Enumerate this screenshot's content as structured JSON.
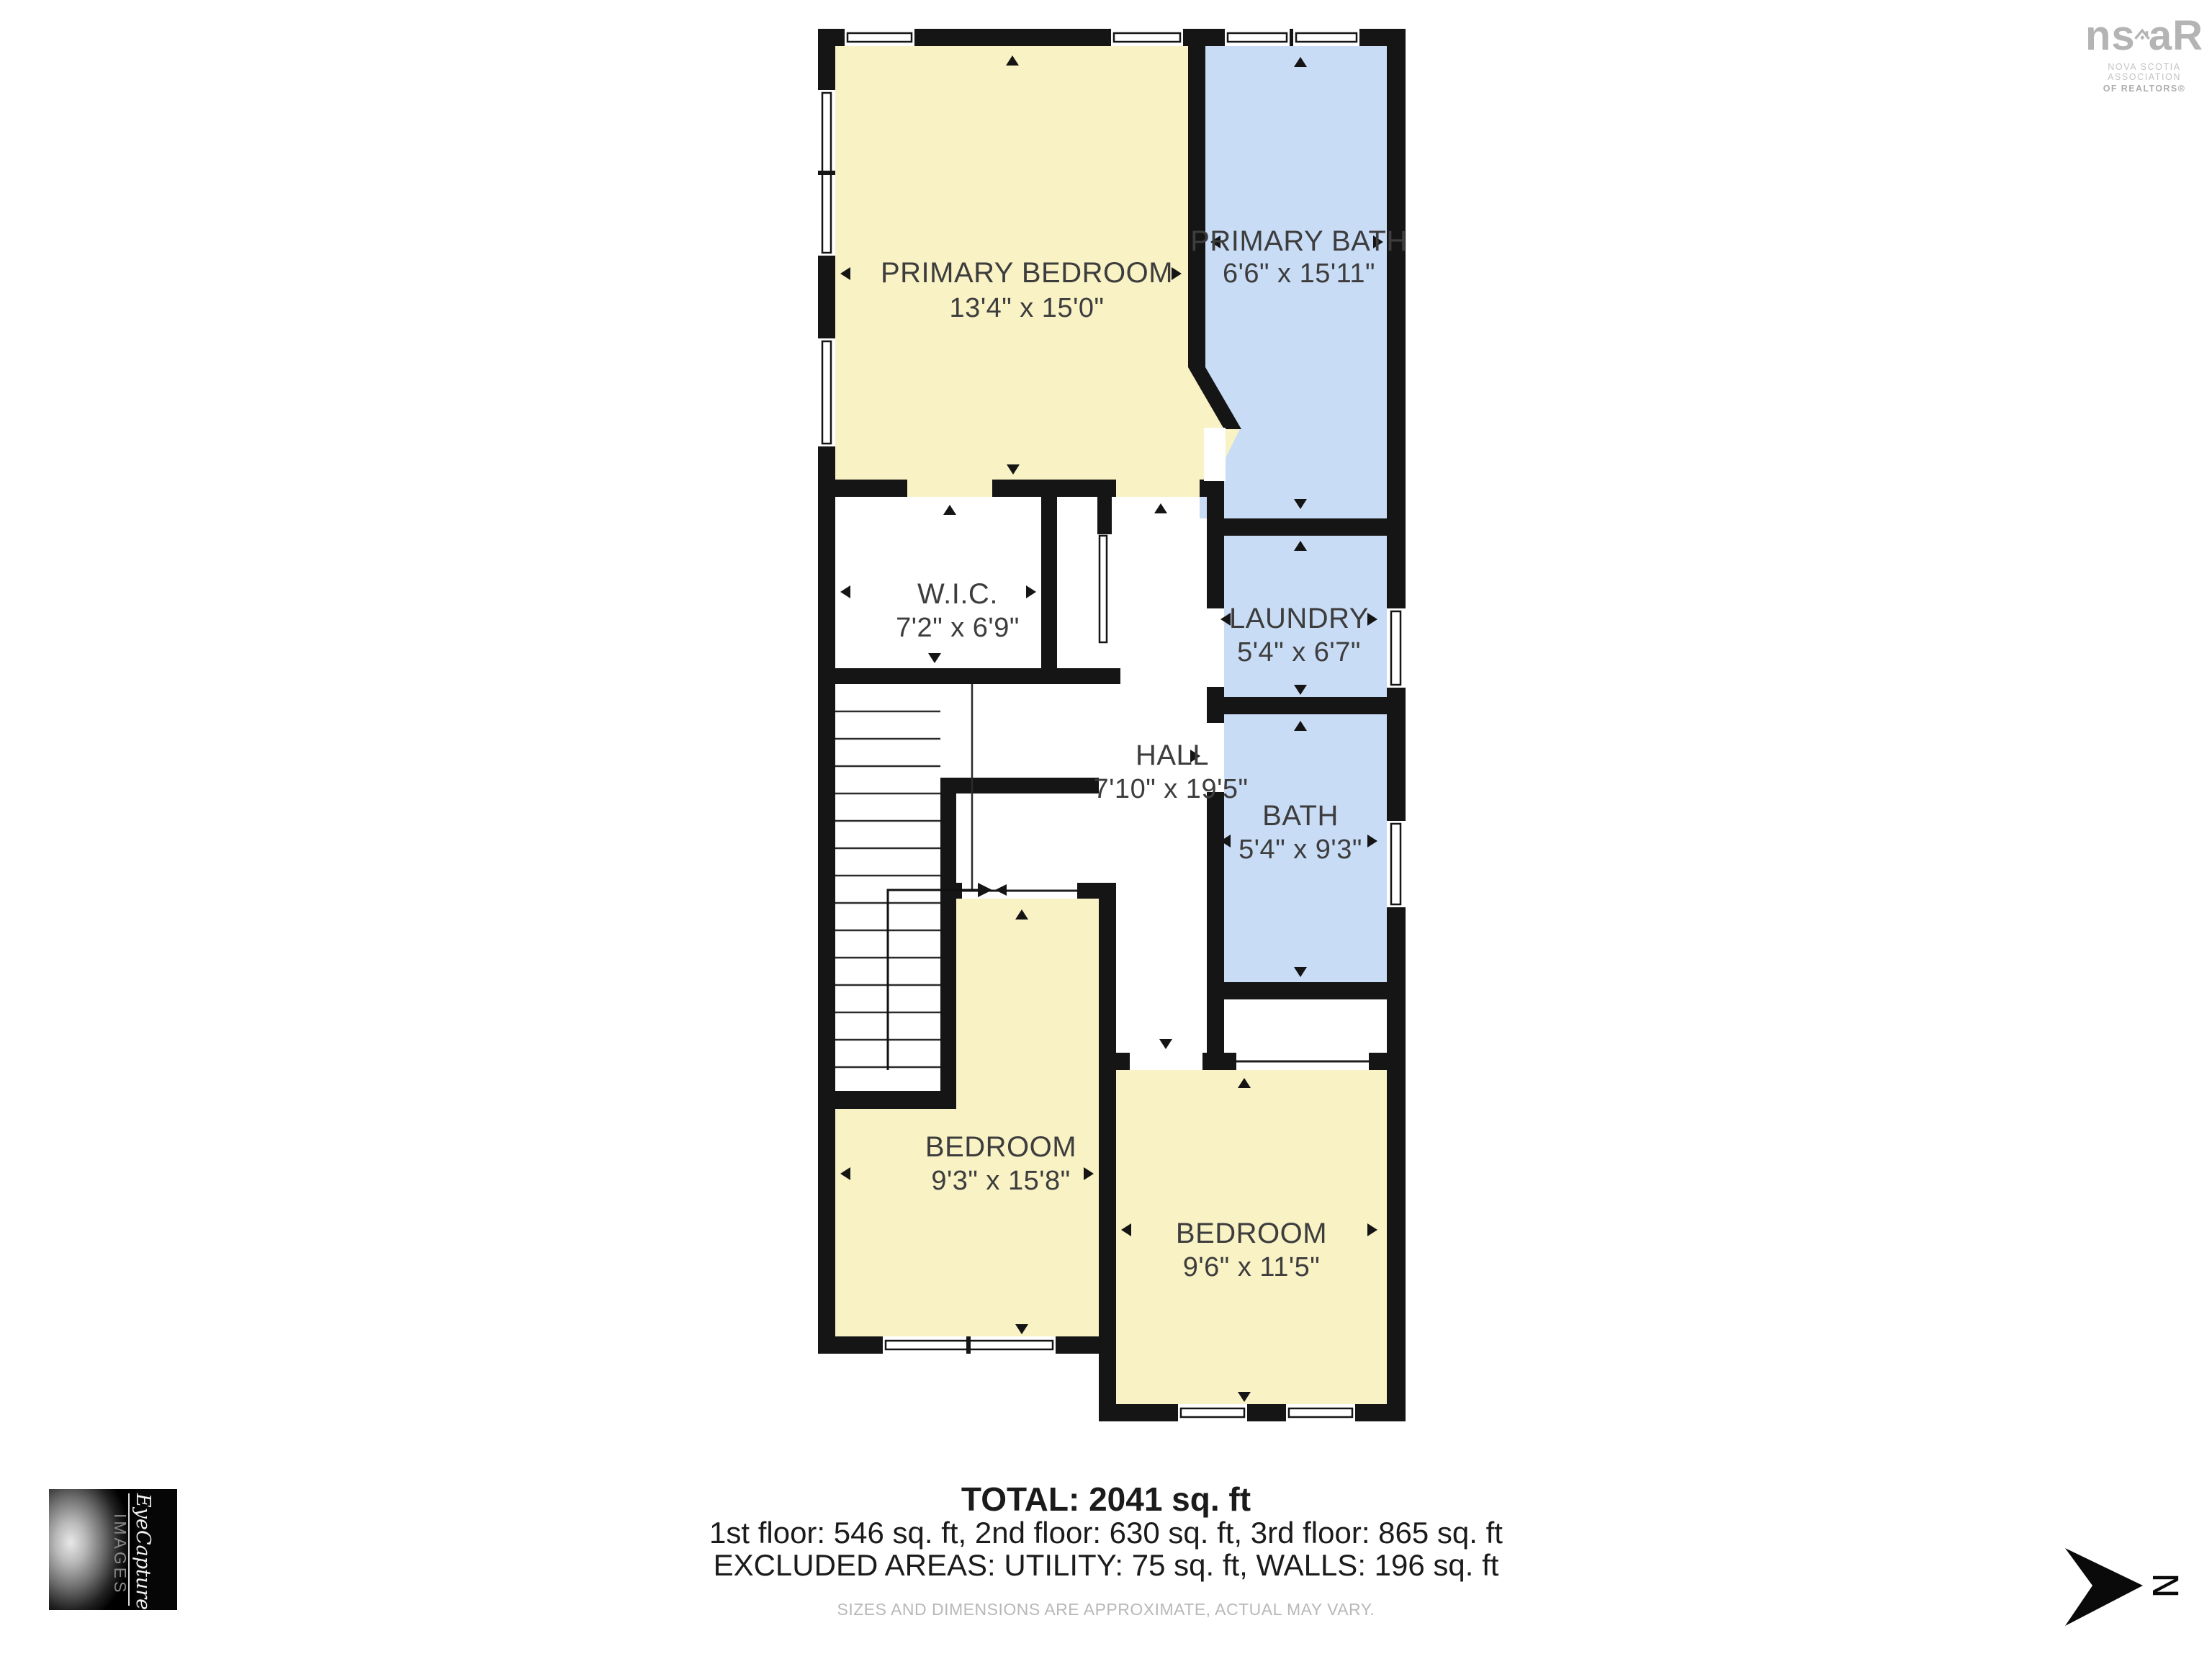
{
  "colors": {
    "wall": "#151515",
    "room_bedroom": "#f9f2c5",
    "room_bath": "#c9dcf6",
    "room_neutral": "#ffffff",
    "label_text": "#3d3d3d",
    "summary_text": "#1b1b1b",
    "muted_text": "#b8b8b8",
    "logo_gray": "#b4b4b4"
  },
  "floorplan": {
    "rooms": [
      {
        "id": "primary-bedroom",
        "name": "PRIMARY BEDROOM",
        "dims": "13'4\" x 15'0\""
      },
      {
        "id": "primary-bath",
        "name": "PRIMARY BATH",
        "dims": "6'6\" x 15'11\""
      },
      {
        "id": "wic",
        "name": "W.I.C.",
        "dims": "7'2\" x 6'9\""
      },
      {
        "id": "laundry",
        "name": "LAUNDRY",
        "dims": "5'4\" x 6'7\""
      },
      {
        "id": "hall",
        "name": "HALL",
        "dims": "7'10\" x 19'5\""
      },
      {
        "id": "bath",
        "name": "BATH",
        "dims": "5'4\" x 9'3\""
      },
      {
        "id": "bedroom-left",
        "name": "BEDROOM",
        "dims": "9'3\" x 15'8\""
      },
      {
        "id": "bedroom-right",
        "name": "BEDROOM",
        "dims": "9'6\" x 11'5\""
      }
    ]
  },
  "summary": {
    "total": "TOTAL: 2041 sq. ft",
    "floors": "1st floor: 546 sq. ft, 2nd floor: 630 sq. ft, 3rd floor: 865 sq. ft",
    "excluded": "EXCLUDED AREAS: UTILITY: 75 sq. ft, WALLS: 196 sq. ft",
    "disclaimer": "SIZES AND DIMENSIONS ARE APPROXIMATE, ACTUAL MAY VARY."
  },
  "branding": {
    "realtor_logo": {
      "prefix": "ns",
      "suffix": "aR",
      "line1": "NOVA SCOTIA ASSOCIATION",
      "line2": "OF REALTORS®"
    },
    "photographer_logo": {
      "script": "EyeCapture",
      "caps": "IMAGES"
    }
  },
  "compass": {
    "label": "N"
  }
}
